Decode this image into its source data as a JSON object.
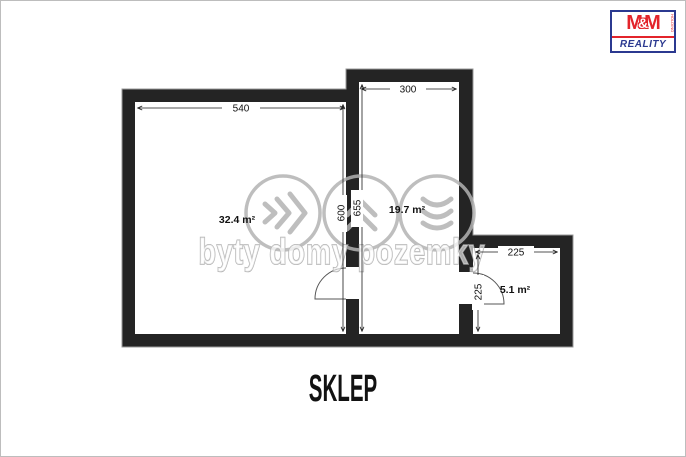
{
  "page": {
    "caption": "SKLEP"
  },
  "logo": {
    "m1": "M",
    "amp": "&",
    "m2": "M",
    "reality": "REALITY",
    "holding": "HOLDING",
    "red": "#e3242b",
    "blue": "#2b3990"
  },
  "floorplan": {
    "wall_color": "#242424",
    "rooms": [
      {
        "name": "large-room",
        "area": "32.4 m²"
      },
      {
        "name": "middle-room",
        "area": "19.7 m²"
      },
      {
        "name": "small-room",
        "area": "5.1 m²"
      }
    ],
    "dims": {
      "large_width": "540",
      "large_height": "600",
      "middle_width": "300",
      "middle_height": "655",
      "small_width": "225",
      "small_height": "225"
    }
  },
  "watermark": {
    "text": "byty domy pozemky",
    "color": "#b3b3b3",
    "icons": [
      "chevrons-right",
      "chevrons-up",
      "chevrons-down"
    ]
  }
}
